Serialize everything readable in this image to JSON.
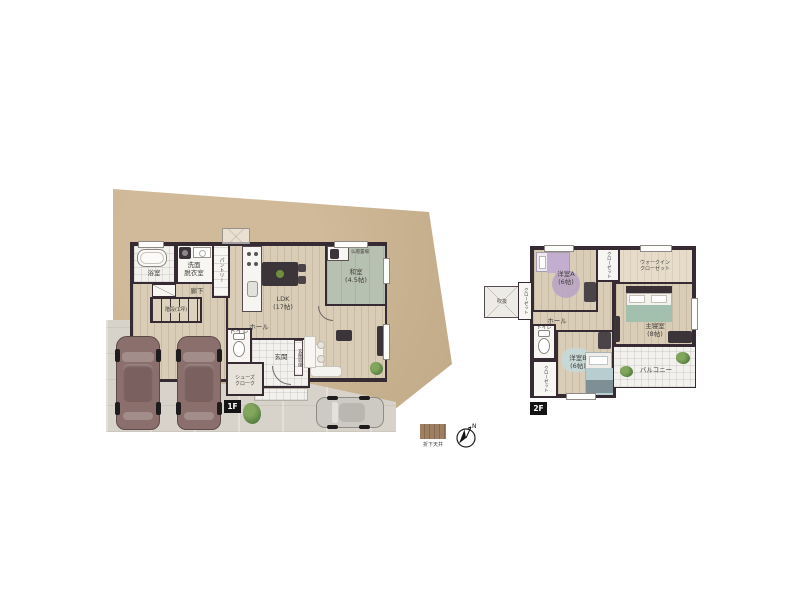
{
  "legend": {
    "dropped_ceiling_label": "折下天井",
    "compass_north": "N"
  },
  "floor1": {
    "badge": "1F",
    "labels": {
      "bath": "浴室",
      "washroom": "洗面\n脱衣室",
      "pantry": "パントリー",
      "hallway": "廊下",
      "stairs": "階段(1坪)",
      "ldk": "LDK\n(17帖)",
      "washitsu": "和室\n(4.5帖)",
      "butsudan": "仏壇置場",
      "hall": "ホール",
      "toilet": "トイレ",
      "entrance": "玄関",
      "shoes_cloak": "シューズ\nクローク",
      "entrance_storage": "玄関収納"
    }
  },
  "floor2": {
    "badge": "2F",
    "labels": {
      "void": "吹抜",
      "room_a": "洋室A\n(6帖)",
      "closet_left": "クローゼット",
      "closet_top": "クローゼット",
      "wic": "ウォークイン\nクローゼット",
      "master_bedroom": "主寝室\n(8帖)",
      "hall": "ホール",
      "toilet": "トイレ",
      "room_b": "洋室B\n(6帖)",
      "closet_bottom": "クローゼット",
      "balcony": "バルコニー"
    }
  },
  "colors": {
    "wall": "#362a33",
    "site": "#c8b190",
    "wood_floor": "#d9cdb7",
    "tatami": "#b7c1b1",
    "concrete": "#d7d3ca",
    "accent_purple": "#b9a2c8",
    "accent_teal": "#a3bfae",
    "legend_brown": "#9d7f61",
    "car_body": "#8b6f6d",
    "car_silver": "#cdcac4"
  }
}
